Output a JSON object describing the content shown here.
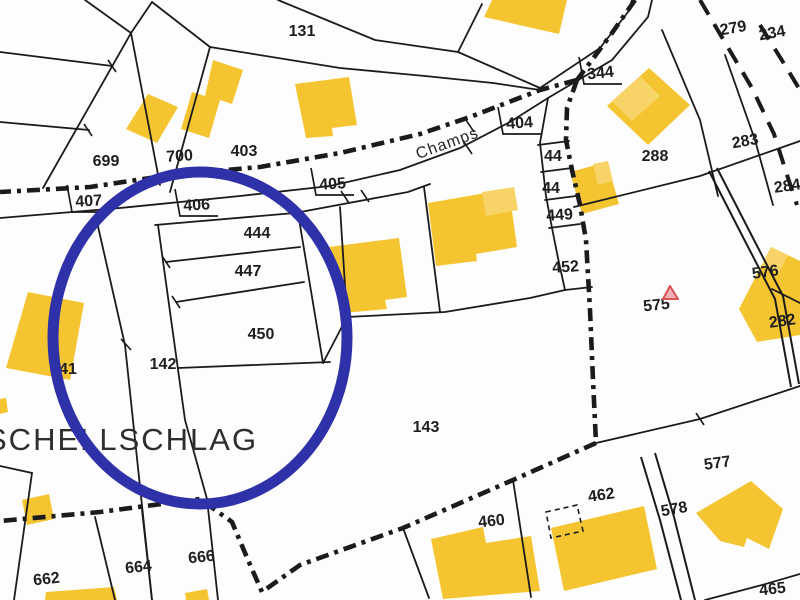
{
  "map": {
    "type": "cadastral-parcel-map",
    "street_label": {
      "text": "Champs",
      "x": 449,
      "y": 148,
      "rot": -20,
      "size": 16,
      "color": "#252525"
    },
    "place_label": {
      "text": "SCHELLSCHLAG",
      "x": -14,
      "y": 450,
      "size": 31,
      "color": "#2e2e2e",
      "letter_spacing": 2
    },
    "colors": {
      "background": "#fdfdfd",
      "line": "#1b1b1b",
      "building": "#F5C531",
      "building_light": "#F8D468",
      "highlight_circle": "#2F31A8",
      "marker_stroke": "#D95454",
      "marker_fill": "#F2AFB8",
      "label_text": "#1e1e1e"
    },
    "highlight_circle": {
      "cx": 200,
      "cy": 338,
      "rx": 147,
      "ry": 166,
      "stroke_width": 11
    },
    "marker_triangle": {
      "points": "663,299 678,299 670,286"
    },
    "parcel_labels": [
      {
        "t": "131",
        "x": 302,
        "y": 36,
        "r": 0
      },
      {
        "t": "279",
        "x": 734,
        "y": 33,
        "r": -10
      },
      {
        "t": "234",
        "x": 773,
        "y": 38,
        "r": -10
      },
      {
        "t": "344",
        "x": 601,
        "y": 78,
        "r": -6,
        "bracket": true
      },
      {
        "t": "404",
        "x": 520,
        "y": 128,
        "r": -4,
        "bracket": true
      },
      {
        "t": "403",
        "x": 244,
        "y": 156,
        "r": 0
      },
      {
        "t": "700",
        "x": 180,
        "y": 161,
        "r": -4
      },
      {
        "t": "699",
        "x": 106,
        "y": 166,
        "r": 0
      },
      {
        "t": "407",
        "x": 89,
        "y": 206,
        "r": -3,
        "bracket": true
      },
      {
        "t": "406",
        "x": 197,
        "y": 210,
        "r": -3,
        "bracket": true
      },
      {
        "t": "405",
        "x": 333,
        "y": 189,
        "r": -4,
        "bracket": true
      },
      {
        "t": "44",
        "x": 553,
        "y": 161,
        "r": 0
      },
      {
        "t": "44",
        "x": 551,
        "y": 193,
        "r": 0
      },
      {
        "t": "449",
        "x": 560,
        "y": 220,
        "r": -4
      },
      {
        "t": "452",
        "x": 566,
        "y": 272,
        "r": -4
      },
      {
        "t": "288",
        "x": 655,
        "y": 161,
        "r": 0
      },
      {
        "t": "283",
        "x": 746,
        "y": 146,
        "r": -10
      },
      {
        "t": "284",
        "x": 788,
        "y": 191,
        "r": -8
      },
      {
        "t": "575",
        "x": 657,
        "y": 310,
        "r": -6
      },
      {
        "t": "576",
        "x": 766,
        "y": 277,
        "r": -8
      },
      {
        "t": "282",
        "x": 783,
        "y": 326,
        "r": -8
      },
      {
        "t": "444",
        "x": 257,
        "y": 238,
        "r": 0
      },
      {
        "t": "447",
        "x": 248,
        "y": 276,
        "r": 0
      },
      {
        "t": "450",
        "x": 261,
        "y": 339,
        "r": 0
      },
      {
        "t": "142",
        "x": 163,
        "y": 369,
        "r": 0
      },
      {
        "t": "41",
        "x": 68,
        "y": 374,
        "r": 0
      },
      {
        "t": "143",
        "x": 426,
        "y": 432,
        "r": 0
      },
      {
        "t": "460",
        "x": 492,
        "y": 526,
        "r": -6
      },
      {
        "t": "462",
        "x": 602,
        "y": 500,
        "r": -8
      },
      {
        "t": "577",
        "x": 718,
        "y": 468,
        "r": -8
      },
      {
        "t": "578",
        "x": 675,
        "y": 514,
        "r": -10
      },
      {
        "t": "465",
        "x": 773,
        "y": 594,
        "r": -6
      },
      {
        "t": "666",
        "x": 202,
        "y": 562,
        "r": -6
      },
      {
        "t": "664",
        "x": 139,
        "y": 572,
        "r": -6
      },
      {
        "t": "662",
        "x": 47,
        "y": 584,
        "r": -6
      }
    ],
    "thin_lines": [
      "M0 52 L112 66",
      "M0 122 L89 130",
      "M85 0 L131 33",
      "M152 2 L131 33",
      "M131 33 L43 188",
      "M131 33 L160 185",
      "M152 2 L210 47",
      "M210 47 L170 192",
      "M278 0 L375 40 L458 52 L540 88",
      "M210 47 L340 68 L425 76 L493 83 L540 90",
      "M458 52 L482 4",
      "M0 218 L120 208 L240 196 L330 186 L400 170 L460 148 L510 122 L548 98",
      "M548 98 L612 60 L648 17 L652 0",
      "M540 88 L600 48 L628 12 L632 0",
      "M574 207 L700 176 L800 141",
      "M662 30 L700 120 L718 196",
      "M725 55 L755 140 L773 205",
      "M548 98 L540 143 L546 196 L552 228 L558 258 L565 290",
      "M538 145 L569 141",
      "M541 172 L572 168",
      "M545 200 L576 196",
      "M549 228 L580 224",
      "M565 290 L592 287",
      "M155 225 L295 213 L408 192 L430 184",
      "M340 207 L347 317",
      "M424 187 L440 312",
      "M347 317 L445 312 L530 298 L565 290",
      "M166 262 L300 247",
      "M176 302 L304 282",
      "M298 213 L323 363",
      "M178 368 L330 362",
      "M323 363 L347 317",
      "M97 222 L125 345 L152 600",
      "M158 225 L185 420 L207 499 L218 600",
      "M95 517 L115 600",
      "M142 510 L152 600",
      "M0 466 L32 473 L14 600",
      "M596 443 L700 419 L791 389 L800 386",
      "M772 289 L800 303",
      "M705 600 L762 585 L800 574",
      "M513 480 L531 597",
      "M403 528 L429 598"
    ],
    "double_road_lines": [
      "M709 171 L746 243 L775 299 L791 387",
      "M717 168 L754 240 L783 296 L799 384",
      "M641 457 L660 520 L681 600",
      "M655 453 L674 517 L695 600"
    ],
    "bold_boundary_paths": [
      "M635 0 L612 33 L592 60 L577 80",
      "M577 80 L540 90 L470 117 L420 134 L340 153 L260 167 L170 175 L90 187 L0 192",
      "M577 80 L567 108 L566 140 L572 170 L580 205 L586 240 L590 310 L593 380 L596 443",
      "M596 443 L513 480 L403 528 L300 565 L262 592 L248 560 L232 522 L200 499 L100 512 L0 521"
    ],
    "long_dash_paths": [
      "M700 0 L720 34 L752 88 L774 134 L788 178 L797 205",
      "M760 25 L783 62 L800 90"
    ],
    "tick_marks": [
      "M108 60 L116 72",
      "M84 124 L92 136",
      "M162 256 L170 268",
      "M172 296 L180 308",
      "M341 191 L349 203",
      "M361 190 L369 202",
      "M464 142 L472 154",
      "M121 339 L131 350",
      "M696 413 L704 425",
      "M466 120 L474 132"
    ],
    "buildings": [
      {
        "points": "126,129 148,94 178,107 157,143",
        "light": false
      },
      {
        "points": "213,60 243,70 232,104 220,100 209,138 181,129 192,92 205,96",
        "light": false
      },
      {
        "points": "295,84 349,77 357,125 332,128 333,136 306,138",
        "light": false
      },
      {
        "points": "492,0 567,0 559,34 484,17",
        "light": false
      },
      {
        "points": "607,106 649,68 690,105 648,145",
        "light": false
      },
      {
        "points": "612,101 640,76 660,96 632,121",
        "light": true
      },
      {
        "points": "570,172 607,162 619,204 582,214",
        "light": false
      },
      {
        "points": "593,164 608,161 613,181 598,185",
        "light": true
      },
      {
        "points": "329,247 399,238 407,297 385,300 387,309 344,313",
        "light": false
      },
      {
        "points": "428,203 509,189 517,247 476,254 477,261 436,266",
        "light": false
      },
      {
        "points": "482,192 514,187 518,210 486,216",
        "light": true
      },
      {
        "points": "739,309 771,247 800,261 800,335 757,342",
        "light": false
      },
      {
        "points": "771,247 788,255 779,273 762,265",
        "light": true
      },
      {
        "points": "28,292 84,303 70,380 6,368",
        "light": false
      },
      {
        "points": "22,500 49,494 54,519 27,525",
        "light": false
      },
      {
        "points": "46,592 114,587 117,600 45,600",
        "light": false
      },
      {
        "points": "185,593 207,589 209,600 186,600",
        "light": false
      },
      {
        "points": "431,539 483,527 486,543 531,536 540,591 443,599",
        "light": false
      },
      {
        "points": "551,528 644,506 657,569 564,591",
        "light": false
      },
      {
        "points": "696,513 751,481 783,509 769,549 747,538 744,547 720,541",
        "light": false
      },
      {
        "points": "0,399 6,398 8,412 0,414",
        "light": false
      }
    ],
    "dashed_outline_building": {
      "points": "546,512 577,505 583,531 551,538"
    }
  }
}
